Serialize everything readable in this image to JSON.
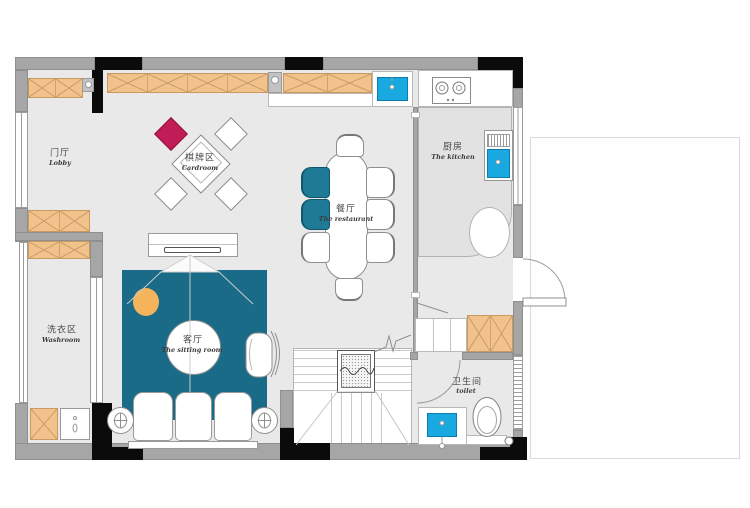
{
  "plan": {
    "title": "residential-floor-plan",
    "rooms": {
      "lobby": {
        "zh": "门厅",
        "en": "Lobby"
      },
      "cardroom": {
        "zh": "棋牌区",
        "en": "Cardroom"
      },
      "restaurant": {
        "zh": "餐厅",
        "en": "The restaurant"
      },
      "kitchen": {
        "zh": "厨房",
        "en": "The kitchen"
      },
      "washroom": {
        "zh": "洗衣区",
        "en": "Washroom"
      },
      "sitting_room": {
        "zh": "客厅",
        "en": "The sitting room"
      },
      "toilet": {
        "zh": "卫生间",
        "en": "toilet"
      }
    },
    "colors": {
      "wall_gray": "#a6a6a6",
      "wall_black": "#0b0b0b",
      "floor_gray": "#e9e9e9",
      "cabinet_tan": "#f2c28c",
      "rug_teal": "#1a6b87",
      "chair_teal": "#1e7a95",
      "accent_crimson": "#c01d56",
      "sink_blue": "#19a8e0",
      "pouf_orange": "#f5b35c"
    }
  }
}
